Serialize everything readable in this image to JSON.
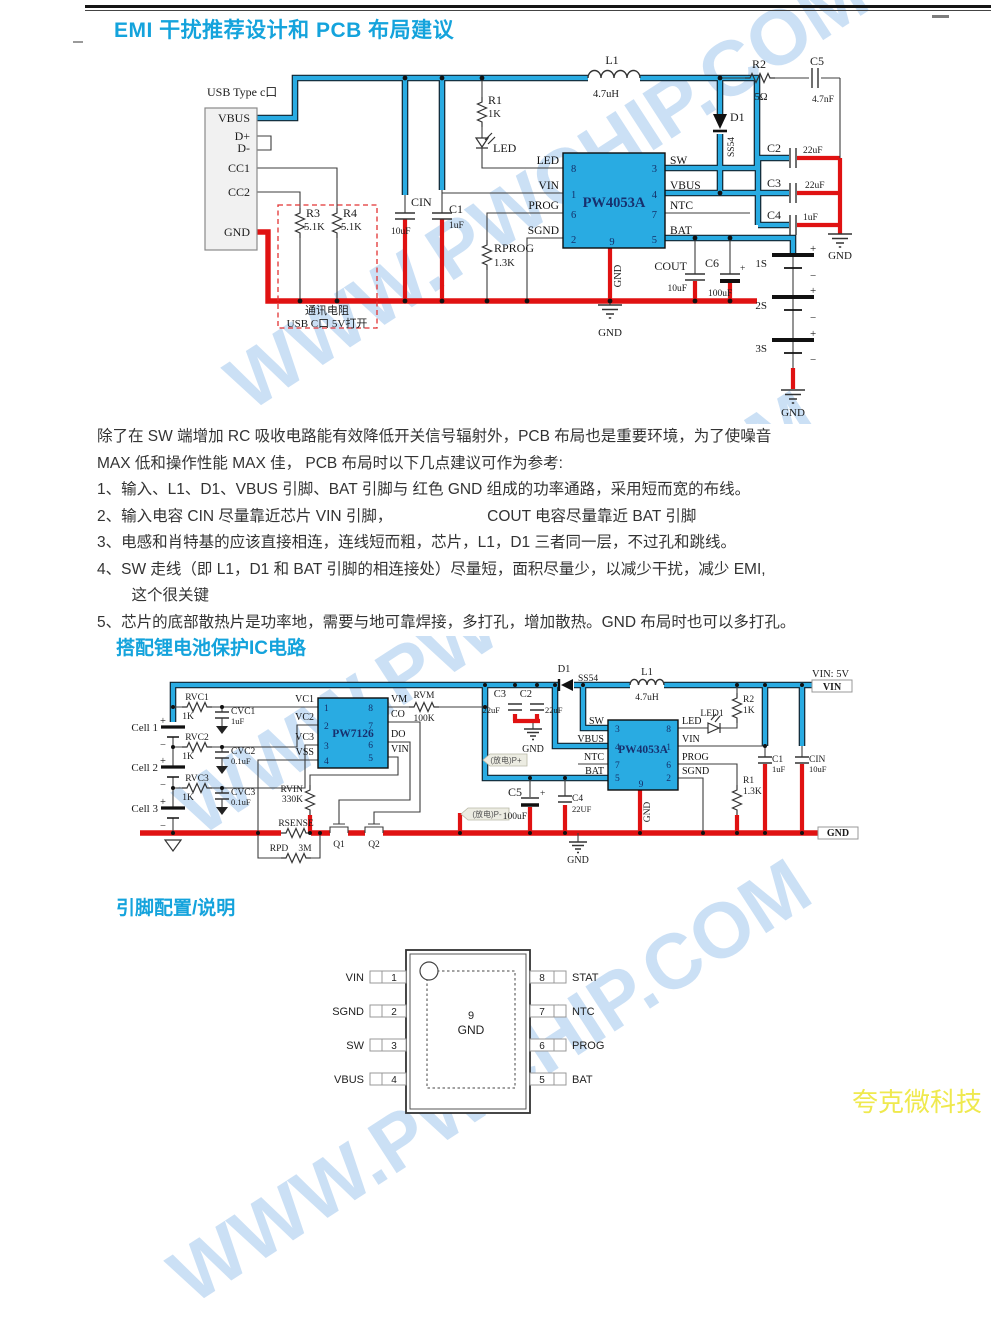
{
  "header": {
    "title": "EMI 干扰推荐设计和 PCB 布局建议"
  },
  "sections": {
    "s2": "搭配锂电池保护IC电路",
    "s3": "引脚配置/说明"
  },
  "watermark": "WWW.PWCHIP.COM",
  "brand": "夸克微科技",
  "colors": {
    "accent": "#14A3DC",
    "trace_blue": "#29ABE2",
    "trace_red": "#E01212",
    "brand_yellow": "#EFE94E",
    "chip_fill": "#29ABE2"
  },
  "notes": {
    "intro1": "除了在 SW 端增加 RC 吸收电路能有效降低开关信号辐射外，PCB 布局也是重要环境，为了使噪音",
    "intro2": "MAX 低和操作性能 MAX 佳， PCB 布局时以下几点建议可作为参考:",
    "items": [
      "1、输入、L1、D1、VBUS 引脚、BAT 引脚与 红色 GND 组成的功率通路，采用短而宽的布线。",
      "2、输入电容 CIN 尽量靠近芯片 VIN 引脚，                      COUT 电容尽量靠近 BAT 引脚",
      "3、电感和肖特基的应该直接相连，连线短而粗，芯片，L1，D1 三者同一层，不过孔和跳线。",
      "4、SW 走线（即 L1，D1 和 BAT 引脚的相连接处）尽量短，面积尽量少，以减少干扰，减少 EMI,",
      "        这个很关键",
      "5、芯片的底部散热片是功率地，需要与地可靠焊接，多打孔，增加散热。GND 布局时也可以多打孔。"
    ]
  },
  "c1": {
    "usb_title": "USB Type c口",
    "vbus": "VBUS",
    "dp": "D+",
    "dm": "D-",
    "cc1": "CC1",
    "cc2": "CC2",
    "gnd": "GND",
    "r3": "R3",
    "r3v": "5.1K",
    "r4": "R4",
    "r4v": "5.1K",
    "note1": "通讯电阻",
    "note2": "USB C口 5V打开",
    "cin": "CIN",
    "cinv": "10uF",
    "c1": "C1",
    "c1v": "1uF",
    "r1": "R1",
    "r1v": "1K",
    "led": "LED",
    "l1": "L1",
    "l1v": "4.7uH",
    "d1": "D1",
    "d1v": "SS54",
    "r2": "R2",
    "r2v": "5Ω",
    "c5": "C5",
    "c5v": "4.7nF",
    "c2": "C2",
    "c2v": "22uF",
    "c3": "C3",
    "c3v": "22uF",
    "c4": "C4",
    "c4v": "1uF",
    "chip": "PW4053A",
    "n1": "1",
    "n2": "2",
    "n3": "3",
    "n4": "4",
    "n5": "5",
    "n6": "6",
    "n7": "7",
    "n8": "8",
    "n9": "9",
    "lled": "LED",
    "lvin": "VIN",
    "lprog": "PROG",
    "lsgnd": "SGND",
    "lsw": "SW",
    "lvbus": "VBUS",
    "lntc": "NTC",
    "lbat": "BAT",
    "rprog": "RPROG",
    "rprogv": "1.3K",
    "cout": "COUT",
    "coutv": "10uF",
    "c6": "C6",
    "c6v": "100uF",
    "gnd9": "GND",
    "gnd_mid": "GND",
    "gnd_r": "GND",
    "gnd_b": "GND",
    "s1": "1S",
    "s2": "2S",
    "s3": "3S",
    "plus": "+",
    "minus": "−"
  },
  "c2": {
    "cell1": "Cell 1",
    "cell2": "Cell 2",
    "cell3": "Cell 3",
    "rvc1": "RVC1",
    "rvc1v": "1K",
    "cvc1": "CVC1",
    "cvc1v": "1uF",
    "rvc2": "RVC2",
    "rvc2v": "1K",
    "cvc2": "CVC2",
    "cvc2v": "0.1uF",
    "rvc3": "RVC3",
    "rvc3v": "1K",
    "cvc3": "CVC3",
    "cvc3v": "0.1uF",
    "chipA": "PW7126",
    "a1": "1",
    "a2": "2",
    "a3": "3",
    "a4": "4",
    "a5": "5",
    "a6": "6",
    "a7": "7",
    "a8": "8",
    "vc1": "VC1",
    "vc2": "VC2",
    "vc3": "VC3",
    "vss": "VSS",
    "vm": "VM",
    "co": "CO",
    "do": "DO",
    "avin": "VIN",
    "rvm": "RVM",
    "rvmv": "100K",
    "rvin": "RVIN",
    "rvinv": "330K",
    "rsense": "RSENSE",
    "rpd": "RPD",
    "rpdv": "3M",
    "q1": "Q1",
    "q2": "Q2",
    "kc3": "C3",
    "kc3v": "22uF",
    "kc2": "C2",
    "kc2v": "22uF",
    "gnd1": "GND",
    "d1": "D1",
    "d1v": "SS54",
    "l1": "L1",
    "l1v": "4.7uH",
    "chipB": "PW4053A",
    "b3": "3",
    "b4": "4",
    "b7": "7",
    "b5": "5",
    "b8": "8",
    "b1": "1",
    "b6": "6",
    "b2": "2",
    "b9": "9",
    "bsw": "SW",
    "bvbus": "VBUS",
    "bntc": "NTC",
    "bbat": "BAT",
    "bled": "LED",
    "bvin": "VIN",
    "bprog": "PROG",
    "bsgnd": "SGND",
    "gnd9": "GND",
    "gnd3": "GND",
    "r2": "R2",
    "r2v": "1K",
    "led1": "LED1",
    "c5": "C5",
    "c5v": "100uF",
    "c4": "C4",
    "c4v": "22UF",
    "r1": "R1",
    "r1v": "1.3K",
    "c1": "C1",
    "c1v": "1uF",
    "cin": "CIN",
    "cinv": "10uF",
    "vin5": "VIN: 5V",
    "tvin": "VIN",
    "tgnd": "GND",
    "fdp": "(放电)P+",
    "fdm": "(放电)P-",
    "plus": "+",
    "minus": "−"
  },
  "pincfg": {
    "left": [
      "VIN",
      "SGND",
      "SW",
      "VBUS"
    ],
    "leftn": [
      "1",
      "2",
      "3",
      "4"
    ],
    "right": [
      "STAT",
      "NTC",
      "PROG",
      "BAT"
    ],
    "rightn": [
      "8",
      "7",
      "6",
      "5"
    ],
    "pad": "9",
    "padlbl": "GND"
  }
}
